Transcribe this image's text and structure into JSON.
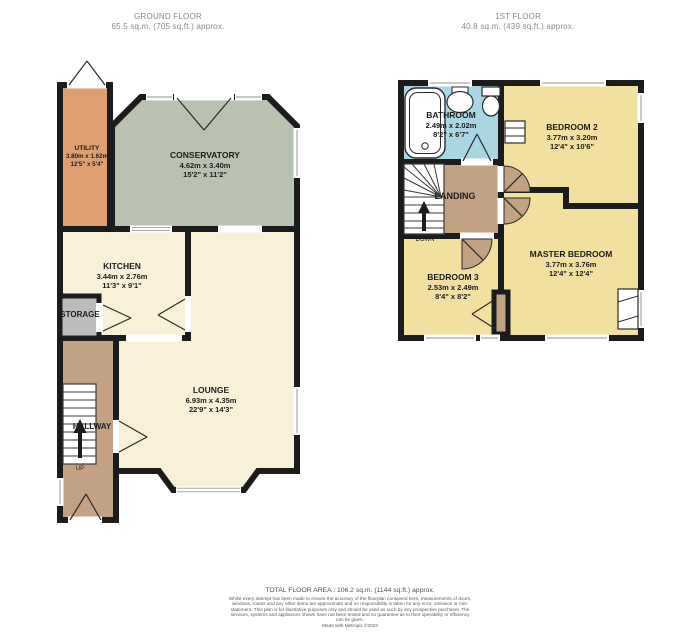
{
  "ground_floor": {
    "title": "GROUND FLOOR",
    "subtitle": "65.5 sq.m. (705 sq.ft.) approx.",
    "rooms": {
      "utility": {
        "name": "UTILITY",
        "metric": "3.80m x 1.62m",
        "imperial": "12'5\" x 5'4\""
      },
      "conservatory": {
        "name": "CONSERVATORY",
        "metric": "4.62m x 3.40m",
        "imperial": "15'2\" x 11'2\""
      },
      "kitchen": {
        "name": "KITCHEN",
        "metric": "3.44m x 2.76m",
        "imperial": "11'3\" x 9'1\""
      },
      "storage": {
        "name": "STORAGE"
      },
      "lounge": {
        "name": "LOUNGE",
        "metric": "6.93m x 4.35m",
        "imperial": "22'9\" x 14'3\""
      },
      "hallway": {
        "name": "HALLWAY",
        "direction_label": "UP"
      }
    }
  },
  "first_floor": {
    "title": "1ST FLOOR",
    "subtitle": "40.8 sq.m. (439 sq.ft.) approx.",
    "rooms": {
      "bathroom": {
        "name": "BATHROOM",
        "metric": "2.49m x 2.02m",
        "imperial": "8'2\" x 6'7\""
      },
      "bedroom2": {
        "name": "BEDROOM 2",
        "metric": "3.77m x 3.20m",
        "imperial": "12'4\" x 10'6\""
      },
      "landing": {
        "name": "LANDING",
        "direction_label": "DOWN"
      },
      "bedroom3": {
        "name": "BEDROOM 3",
        "metric": "2.53m x 2.49m",
        "imperial": "8'4\" x 8'2\""
      },
      "master_bedroom": {
        "name": "MASTER BEDROOM",
        "metric": "3.77m x 3.76m",
        "imperial": "12'4\" x 12'4\""
      }
    }
  },
  "footer": {
    "total_area": "TOTAL FLOOR AREA : 106.2 sq.m. (1144 sq.ft.) approx.",
    "disclaimer": "Whilst every attempt has been made to ensure the accuracy of the floorplan contained here, measurements of doors, windows, rooms and any other items are approximate and no responsibility is taken for any error, omission or mis-statement. This plan is for illustrative purposes only and should be used as such by any prospective purchaser. The services, systems and appliances shown have not been tested and no guarantee as to their operability or efficiency can be given.",
    "credit": "Made with Metropix ©2023"
  },
  "colors": {
    "wall": "#1c1c1c",
    "utility": "#de9f70",
    "conservatory": "#b9c1b1",
    "kitchen": "#f8f1d7",
    "lounge": "#f8f1d7",
    "hallway": "#c2a282",
    "landing": "#c2a282",
    "storage": "#bcbcbc",
    "bathroom": "#a9d6e3",
    "bedroom": "#f2e0a0"
  }
}
